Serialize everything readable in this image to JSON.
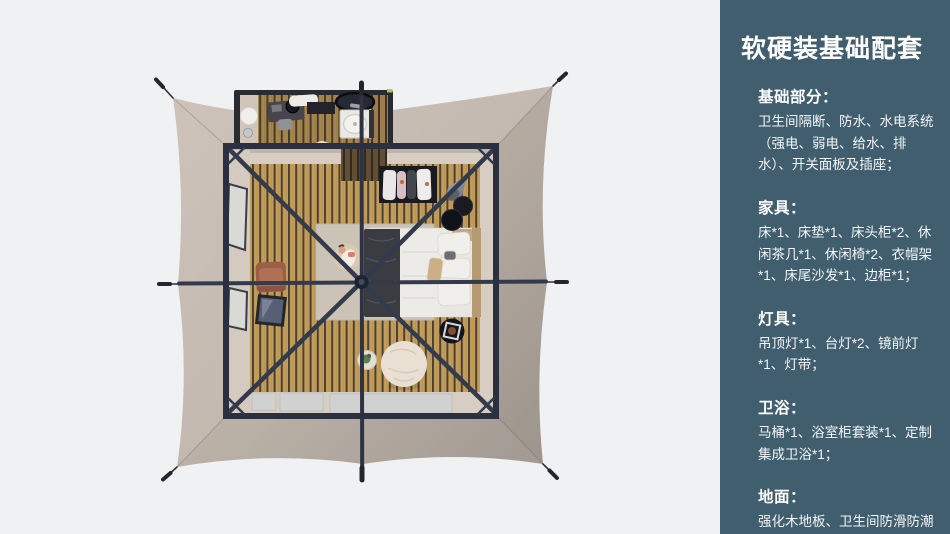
{
  "panel": {
    "title": "软硬装基础配套",
    "bg_color": "#405e6e",
    "text_color": "#ffffff",
    "sections": [
      {
        "heading": "基础部分：",
        "body": "卫生间隔断、防水、水电系统（强电、弱电、给水、排水）、开关面板及插座；"
      },
      {
        "heading": "家具：",
        "body": "床*1、床垫*1、床头柜*2、休闲茶几*1、休闲椅*2、衣帽架*1、床尾沙发*1、边柜*1；"
      },
      {
        "heading": "灯具：",
        "body": "吊顶灯*1、台灯*2、镜前灯*1、灯带；"
      },
      {
        "heading": "卫浴：",
        "body": "马桶*1、浴室柜套装*1、定制集成卫浴*1；"
      },
      {
        "heading": "地面：",
        "body": "强化木地板、卫生间防滑防潮石塑板；"
      }
    ]
  },
  "floorplan": {
    "background_color": "#f0f1f2",
    "canopy_color": "#c9bfb6",
    "canopy_shade_color": "#a69d95",
    "frame_color": "#2d3342",
    "wood_floor_color": "#c49e58",
    "wall_color": "#d8cdc2",
    "rug_color": "#cbc3b5",
    "mat_color": "#cfd2d0",
    "armchair_color": "#a5664b",
    "bean_bag_color": "#e9dfd2",
    "items": [
      "tent-canopy",
      "guy-lines",
      "tent-frame",
      "bathroom",
      "vanity",
      "shower-unit",
      "oval-mirror",
      "bed",
      "pillows",
      "throw-blanket",
      "headboard",
      "clothes-rack",
      "pendant-lamp",
      "nesting-side-tables",
      "round-tray-table",
      "bean-bag",
      "plant-side-table",
      "armchair",
      "floor-mirror",
      "lounger-with-person",
      "entry-mats",
      "area-rug",
      "side-windows"
    ]
  }
}
